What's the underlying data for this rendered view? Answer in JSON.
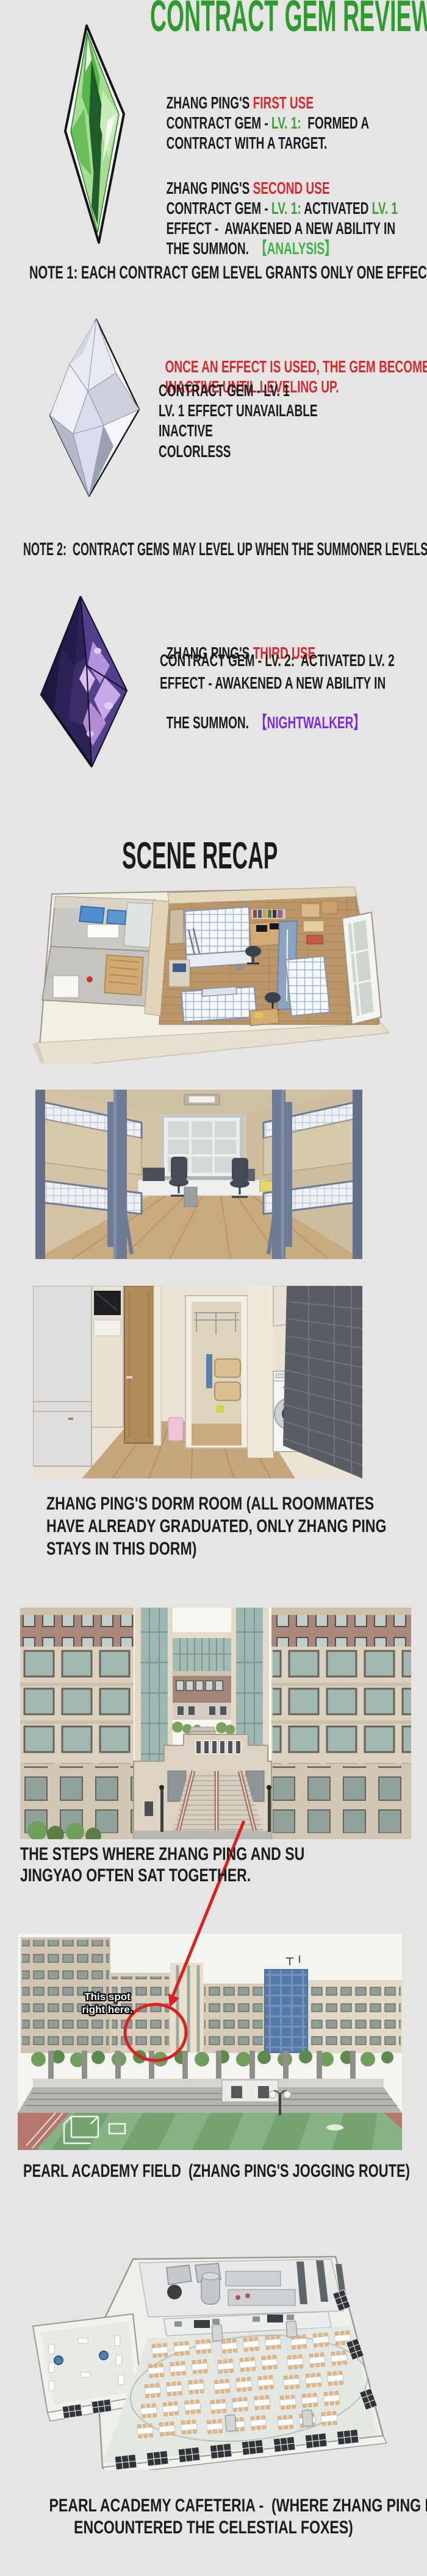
{
  "title": "CONTRACT GEM REVIEW",
  "colors": {
    "background": "#e6e5e3",
    "ink": "#1c1c1c",
    "title_green": "#2e9b2e",
    "level_green": "#3aa33c",
    "bracket_green": "#3cb44a",
    "alert_red": "#d42a32",
    "bracket_purple": "#7b2ce0",
    "annotation_red": "#dd1f1f"
  },
  "gem_sections": {
    "first": {
      "gem": "green-contract-gem",
      "line1_black": "ZHANG PING'S ",
      "line1_red": "FIRST USE",
      "line2_a": "CONTRACT GEM - ",
      "line2_green": "LV. 1:",
      "line2_b": "  FORMED A",
      "line3": "CONTRACT WITH A TARGET."
    },
    "second": {
      "line1_black": "ZHANG PING'S ",
      "line1_red": "SECOND USE",
      "line2_a": "CONTRACT GEM - ",
      "line2_green1": "LV. 1:",
      "line2_b": " ACTIVATED ",
      "line2_green2": "LV. 1",
      "line3": "EFFECT -  AWAKENED A NEW ABILITY IN",
      "line4_black": "THE SUMMON.  ",
      "line4_green": "【ANALYSIS】"
    },
    "inactive": {
      "gem": "colorless-contract-gem",
      "red_line1": "ONCE AN EFFECT IS USED, THE GEM BECOMES",
      "red_line2": "INACTIVE UNTIL LEVELING UP.",
      "line3": "CONTRACT GEM - LV. 1",
      "line4": "LV. 1 EFFECT UNAVAILABLE",
      "line5": "INACTIVE",
      "line6": "COLORLESS"
    },
    "third": {
      "gem": "purple-contract-gem",
      "line1_black": "ZHANG PING'S ",
      "line1_red": "THIRD USE",
      "line2": "CONTRACT GEM - LV. 2:  ACTIVATED LV. 2",
      "line3": "EFFECT - AWAKENED A NEW ABILITY IN",
      "line4_black": "THE SUMMON.  ",
      "line4_purple": "【NIGHTWALKER】"
    }
  },
  "notes": {
    "note1": "NOTE 1: EACH CONTRACT GEM LEVEL GRANTS ONLY ONE EFFECT",
    "note2": "NOTE 2:  CONTRACT GEMS MAY LEVEL UP WHEN THE SUMMONER LEVELS UP."
  },
  "scene_recap": {
    "heading": "SCENE RECAP",
    "captions": {
      "dorm_line1": "ZHANG PING'S DORM ROOM (ALL ROOMMATES",
      "dorm_line2": "HAVE ALREADY GRADUATED, ONLY ZHANG PING",
      "dorm_line3": "STAYS IN THIS DORM)",
      "steps_line1": "THE STEPS WHERE ZHANG PING AND SU",
      "steps_line2": "JINGYAO OFTEN SAT TOGETHER.",
      "field": "PEARL ACADEMY FIELD  (ZHANG PING'S JOGGING ROUTE)",
      "cafeteria_line1": "PEARL ACADEMY CAFETERIA -  (WHERE ZHANG PING FIRST",
      "cafeteria_line2": "ENCOUNTERED THE CELESTIAL FOXES)"
    },
    "annotation": "This spot right here."
  }
}
